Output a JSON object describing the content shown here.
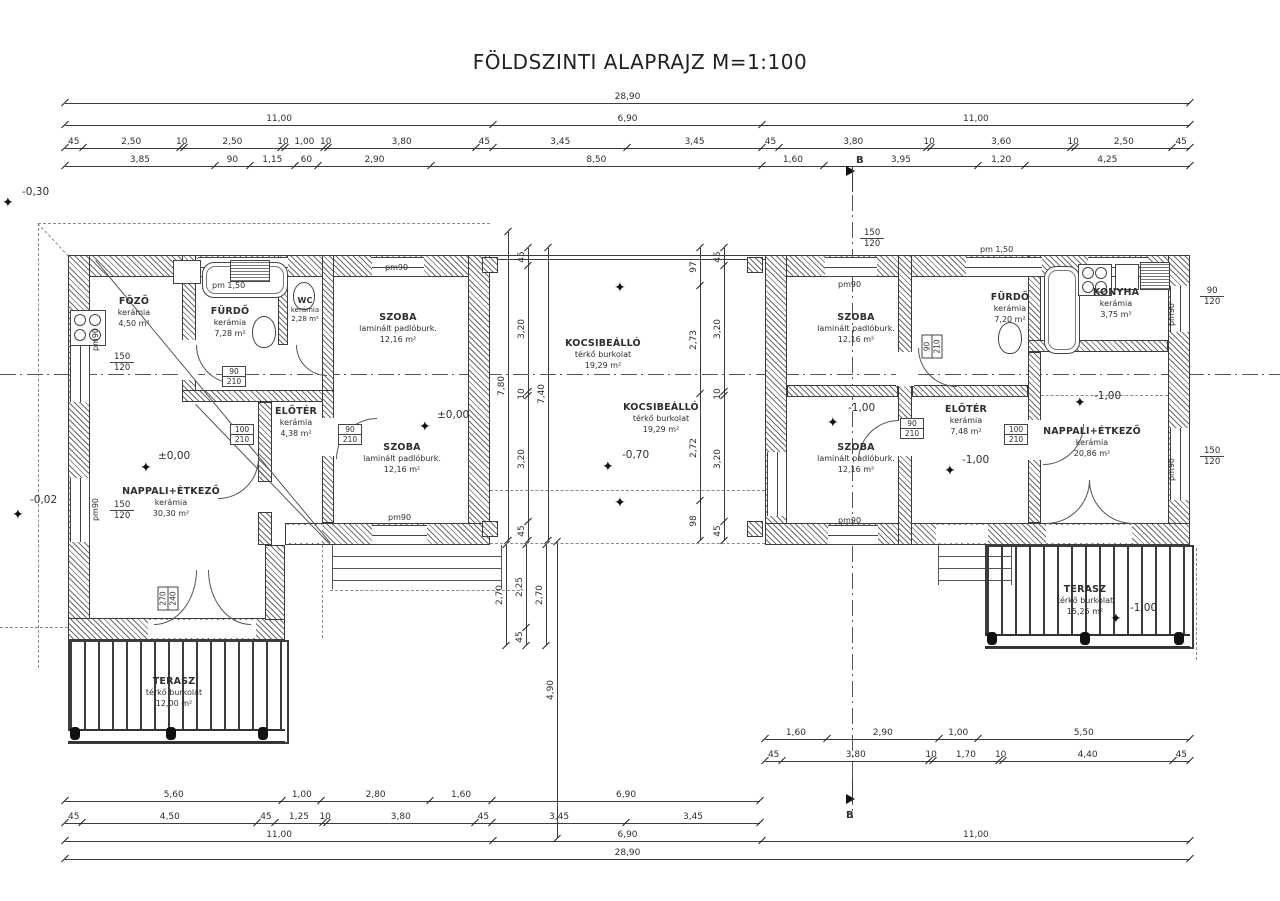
{
  "title": "FÖLDSZINTI ALAPRAJZ M=1:100",
  "colors": {
    "line": "#3c3c3c",
    "text": "#2e2e2e"
  },
  "dims": {
    "top1": [
      "28,90"
    ],
    "top2": [
      "11,00",
      "6,90",
      "11,00"
    ],
    "top3": [
      "45",
      "2,50",
      "10",
      "2,50",
      "10",
      "1,00",
      "10",
      "3,80",
      "45",
      "3,45",
      "3,45",
      "45",
      "3,80",
      "10",
      "3,60",
      "10",
      "2,50",
      "45"
    ],
    "top4": [
      "3,85",
      "90",
      "1,15",
      "60",
      "2,90",
      "8,50",
      "1,60",
      "3,95",
      "1,20",
      "4,25"
    ],
    "bl1": [
      "5,60",
      "1,00",
      "2,80",
      "1,60",
      "6,90"
    ],
    "bl2": [
      "45",
      "4,50",
      "45",
      "1,25",
      "10",
      "3,80",
      "45",
      "3,45",
      "3,45"
    ],
    "b3": [
      "11,00",
      "6,90",
      "11,00"
    ],
    "b4": [
      "28,90"
    ],
    "br1": [
      "1,60",
      "2,90",
      "1,00",
      "5,50"
    ],
    "br2": [
      "45",
      "3,80",
      "10",
      "1,70",
      "10",
      "4,40",
      "45"
    ],
    "cl_a": [
      "7,80"
    ],
    "cl_b": [
      "45",
      "3,20",
      "10",
      "3,20",
      "45"
    ],
    "cl_c": [
      "7,40"
    ],
    "cr_a": [
      "97",
      "2,73",
      "2,72",
      "98"
    ],
    "cr_b": [
      "45",
      "3,20",
      "10",
      "3,20",
      "45"
    ],
    "m1": [
      "2,70"
    ],
    "m2": [
      "2,25",
      "45"
    ],
    "m3": [
      "2,70"
    ],
    "m4": [
      "4,90"
    ]
  },
  "rooms": [
    {
      "name": "FŐZŐ",
      "material": "kerámia",
      "area": "4,50 m²"
    },
    {
      "name": "FÜRDŐ",
      "material": "kerámia",
      "area": "7,28 m²"
    },
    {
      "name": "WC",
      "material": "kerámia",
      "area": "2,28 m²"
    },
    {
      "name": "SZOBA",
      "material": "laminált padlóburk.",
      "area": "12,16 m²"
    },
    {
      "name": "ELŐTÉR",
      "material": "kerámia",
      "area": "4,38 m²"
    },
    {
      "name": "SZOBA",
      "material": "laminált padlóburk.",
      "area": "12,16 m²"
    },
    {
      "name": "NAPPALI+ÉTKEZŐ",
      "material": "kerámia",
      "area": "30,30 m²"
    },
    {
      "name": "TERASZ",
      "material": "térkő burkolat",
      "area": "12,00 m²"
    },
    {
      "name": "KOCSIBEÁLLÓ",
      "material": "térkő burkolat",
      "area": "19,29 m²"
    },
    {
      "name": "KOCSIBEÁLLÓ",
      "material": "térkő burkolat",
      "area": "19,29 m²"
    },
    {
      "name": "SZOBA",
      "material": "laminált padlóburk.",
      "area": "12,16 m²"
    },
    {
      "name": "FÜRDŐ",
      "material": "kerámia",
      "area": "7,20 m²"
    },
    {
      "name": "KONYHA",
      "material": "kerámia",
      "area": "3,75 m²"
    },
    {
      "name": "SZOBA",
      "material": "laminált padlóburk.",
      "area": "12,16 m²"
    },
    {
      "name": "ELŐTÉR",
      "material": "kerámia",
      "area": "7,48 m²"
    },
    {
      "name": "NAPPALI+ÉTKEZŐ",
      "material": "kerámia",
      "area": "20,86 m²"
    },
    {
      "name": "TERASZ",
      "material": "térkő burkolat",
      "area": "15,25 m²"
    }
  ],
  "levels": [
    "-0,30",
    "-0,02",
    "±0,00",
    "±0,00",
    "-0,70",
    "-1,00",
    "-1,00",
    "-1,00",
    "-1,00"
  ],
  "doors": [
    {
      "w": "90",
      "h": "210"
    },
    {
      "w": "100",
      "h": "210"
    },
    {
      "w": "90",
      "h": "210"
    },
    {
      "w": "90",
      "h": "210"
    },
    {
      "w": "90",
      "h": "210"
    },
    {
      "w": "100",
      "h": "210"
    },
    {
      "w": "270",
      "h": "240"
    }
  ],
  "windows": [
    {
      "t": "150",
      "b": "120"
    },
    {
      "t": "150",
      "b": "120"
    },
    {
      "t": "90",
      "b": "120"
    },
    {
      "t": "150",
      "b": "120"
    },
    {
      "t": "150",
      "b": "120"
    }
  ],
  "pm": [
    "pm 1,50",
    "pm90",
    "pm90",
    "pm90",
    "pm 1,50",
    "pm90",
    "pm90",
    "pm90",
    "pm90",
    "pm90"
  ],
  "section": {
    "label": "B"
  }
}
